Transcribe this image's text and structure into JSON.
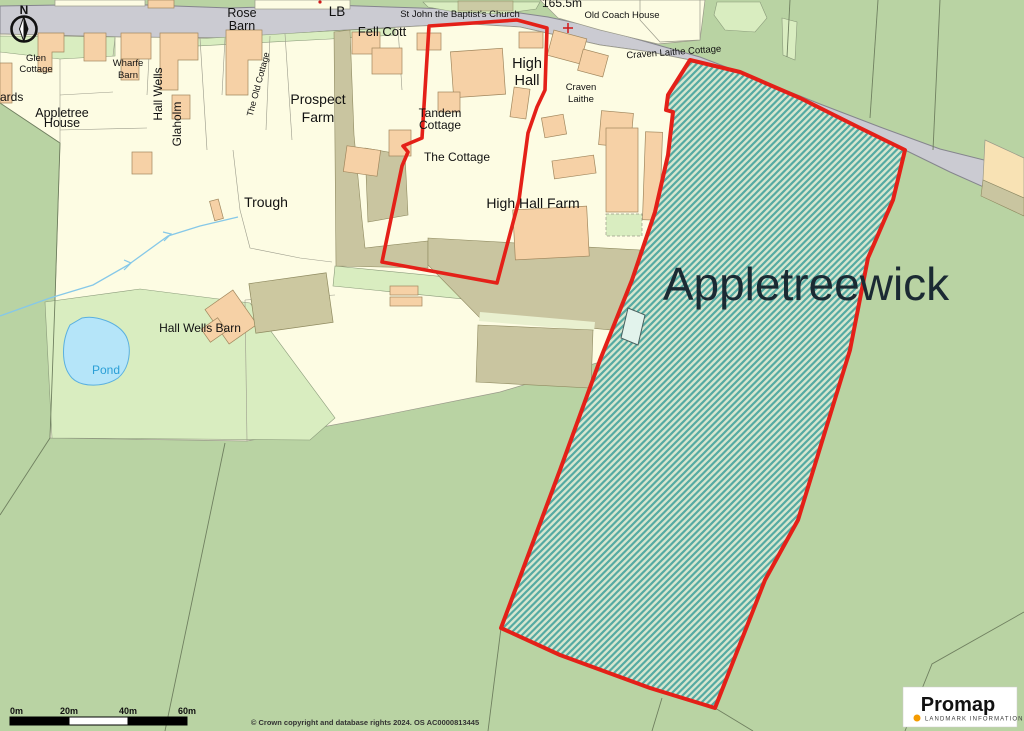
{
  "map": {
    "title": "Promap location plan - Appletreewick",
    "labels": [
      {
        "name": "compass-n",
        "text": "N",
        "x": 24,
        "y": 14,
        "size": 12,
        "weight": "bold"
      },
      {
        "name": "rose-barn",
        "lines": [
          "Rose",
          "Barn"
        ],
        "x": 242,
        "y": 17,
        "size": 12.5,
        "lh": 13
      },
      {
        "name": "lb",
        "text": "LB",
        "x": 337,
        "y": 16,
        "size": 13.5
      },
      {
        "name": "st-john-church",
        "text": "St John the Baptist's Church",
        "x": 460,
        "y": 17,
        "size": 9.5
      },
      {
        "name": "spot-height",
        "text": "165.5m",
        "x": 562,
        "y": 7,
        "size": 12
      },
      {
        "name": "old-coach-house",
        "text": "Old Coach House",
        "x": 622,
        "y": 18,
        "size": 9.5
      },
      {
        "name": "craven-laithe-cottage",
        "text": "Craven Laithe Cottage",
        "x": 674,
        "y": 55,
        "size": 9.5,
        "rotate": -4
      },
      {
        "name": "fell-cott",
        "text": "Fell Cott",
        "x": 382,
        "y": 36,
        "size": 13
      },
      {
        "name": "high-hall",
        "lines": [
          "High",
          "Hall"
        ],
        "x": 527,
        "y": 68,
        "size": 14.5,
        "lh": 17
      },
      {
        "name": "craven-laithe",
        "lines": [
          "Craven",
          "Laithe"
        ],
        "x": 581,
        "y": 90,
        "size": 9.5,
        "lh": 12
      },
      {
        "name": "glen-cottage",
        "lines": [
          "Glen",
          "Cottage"
        ],
        "x": 36,
        "y": 61,
        "size": 9.5,
        "lh": 11
      },
      {
        "name": "ards",
        "text": "ards",
        "x": 0,
        "y": 101,
        "size": 12,
        "anchor": "start"
      },
      {
        "name": "appletree-house",
        "lines": [
          "Appletree",
          "House"
        ],
        "x": 62,
        "y": 117,
        "size": 12.5,
        "lh": 10
      },
      {
        "name": "wharfe-barn",
        "lines": [
          "Wharfe",
          "Barn"
        ],
        "x": 128,
        "y": 66,
        "size": 9.5,
        "lh": 12
      },
      {
        "name": "hall-wells",
        "text": "Hall Wells",
        "x": 162,
        "y": 94,
        "size": 12,
        "rotate": -90
      },
      {
        "name": "glaholm",
        "text": "Glaholm",
        "x": 181,
        "y": 124,
        "size": 12,
        "rotate": -90
      },
      {
        "name": "the-old-cottage",
        "text": "The Old Cottage",
        "x": 261,
        "y": 85,
        "size": 9,
        "rotate": -75
      },
      {
        "name": "prospect-farm",
        "lines": [
          "Prospect",
          "Farm"
        ],
        "x": 318,
        "y": 104,
        "size": 14,
        "lh": 18
      },
      {
        "name": "trough",
        "text": "Trough",
        "x": 266,
        "y": 207,
        "size": 14
      },
      {
        "name": "tandem-cottage",
        "lines": [
          "Tandem",
          "Cottage"
        ],
        "x": 440,
        "y": 117,
        "size": 12,
        "lh": 12
      },
      {
        "name": "the-cottage",
        "text": "The Cottage",
        "x": 457,
        "y": 161,
        "size": 12
      },
      {
        "name": "high-hall-farm",
        "text": "High Hall Farm",
        "x": 533,
        "y": 208,
        "size": 14
      },
      {
        "name": "hall-wells-barn",
        "text": "Hall Wells Barn",
        "x": 200,
        "y": 332,
        "size": 12
      },
      {
        "name": "pond",
        "text": "Pond",
        "x": 106,
        "y": 374,
        "size": 12,
        "color": "#2b9fd6"
      },
      {
        "name": "appletreewick",
        "text": "Appletreewick",
        "x": 806,
        "y": 300,
        "size": 46,
        "color": "#1b2a33"
      },
      {
        "name": "scale-0m",
        "text": "0m",
        "x": 10,
        "y": 714,
        "size": 9,
        "weight": "bold",
        "anchor": "start"
      },
      {
        "name": "scale-20m",
        "text": "20m",
        "x": 69,
        "y": 714,
        "size": 9,
        "weight": "bold"
      },
      {
        "name": "scale-40m",
        "text": "40m",
        "x": 128,
        "y": 714,
        "size": 9,
        "weight": "bold"
      },
      {
        "name": "scale-60m",
        "text": "60m",
        "x": 187,
        "y": 714,
        "size": 9,
        "weight": "bold"
      },
      {
        "name": "copyright",
        "text": "© Crown copyright and database rights 2024. OS AC0000813445",
        "x": 365,
        "y": 725,
        "size": 7.5,
        "weight": "bold",
        "color": "#333333"
      },
      {
        "name": "promap-brand",
        "text": "Promap",
        "x": 958,
        "y": 711,
        "size": 20,
        "weight": "bold",
        "color": "#111111"
      },
      {
        "name": "promap-tagline",
        "text": "LANDMARK INFORMATION",
        "x": 925,
        "y": 720.5,
        "size": 6,
        "anchor": "start",
        "color": "#3a3a3a",
        "spacing": 1.1
      }
    ],
    "icons": [
      "north-arrow-compass",
      "scale-bar",
      "promap-logo-dot",
      "church-cross-marker"
    ],
    "colors": {
      "boundary_red": "#e42018",
      "hatch_teal": "#55aaa2",
      "field_green": "#b9d3a3",
      "light_green": "#d9edc0",
      "parcel_cream": "#fdfce3",
      "building_peach": "#f6d1a6",
      "building_khaki": "#ccc8a0",
      "road_grey": "#cbcbd2",
      "pond_blue": "#b5e5f9",
      "logo_orange": "#f59b00"
    }
  }
}
